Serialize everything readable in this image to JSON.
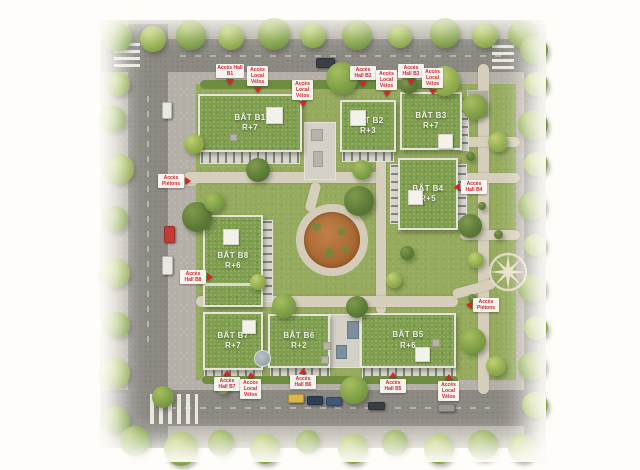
{
  "colors": {
    "accent_red": "#d6232a",
    "roof_green": "#7f9e4e",
    "lawn_green": "#95aa5d",
    "road_gray": "#8d8a84",
    "path_beige": "#d6cfbc",
    "facade_beige": "#d8d5cb"
  },
  "buildings": [
    {
      "id": "b1",
      "name": "BÂT B1",
      "level": "R+7"
    },
    {
      "id": "b2",
      "name": "BÂT B2",
      "level": "R+3"
    },
    {
      "id": "b3",
      "name": "BÂT B3",
      "level": "R+7"
    },
    {
      "id": "b4",
      "name": "BÂT B4",
      "level": "R+5"
    },
    {
      "id": "b8",
      "name": "BÂT B8",
      "level": "R+6"
    },
    {
      "id": "b7",
      "name": "BÂT B7",
      "level": "R+7"
    },
    {
      "id": "b6",
      "name": "BÂT B6",
      "level": "R+2"
    },
    {
      "id": "b5",
      "name": "BÂT B5",
      "level": "R+6"
    }
  ],
  "access_labels": [
    {
      "text": "Accès Hall B1",
      "direction": "down"
    },
    {
      "text": "Accès Local Vélos",
      "direction": "down"
    },
    {
      "text": "Accès Local Vélos",
      "direction": "down"
    },
    {
      "text": "Accès Hall B2",
      "direction": "down"
    },
    {
      "text": "Accès Local Vélos",
      "direction": "down"
    },
    {
      "text": "Accès Hall B3",
      "direction": "down"
    },
    {
      "text": "Accès Local Vélos",
      "direction": "down"
    },
    {
      "text": "Accès Piétons",
      "direction": "right"
    },
    {
      "text": "Accès Hall B8",
      "direction": "right"
    },
    {
      "text": "Accès Hall B4",
      "direction": "left"
    },
    {
      "text": "Accès Piétons",
      "direction": "left"
    },
    {
      "text": "Accès Hall B7",
      "direction": "up"
    },
    {
      "text": "Accès Local Vélos",
      "direction": "up"
    },
    {
      "text": "Accès Hall B6",
      "direction": "up"
    },
    {
      "text": "Accès Hall B5",
      "direction": "up"
    },
    {
      "text": "Accès Local Vélos",
      "direction": "up"
    }
  ]
}
